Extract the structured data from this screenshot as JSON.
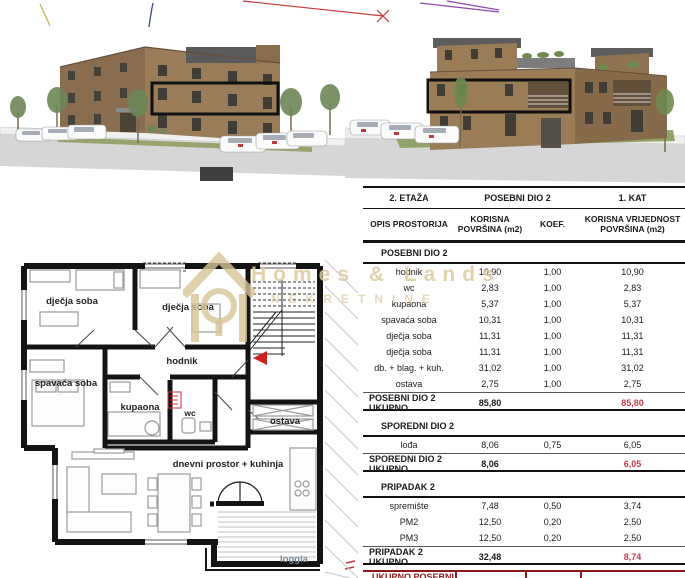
{
  "watermark": {
    "brand": "Homes & Lands",
    "subtitle": "NEKRETNINE"
  },
  "floor_plan": {
    "rooms": {
      "child1": "dječja soba",
      "child2": "dječja soba",
      "bedroom": "spavaća soba",
      "hall": "hodnik",
      "bathroom": "kupaona",
      "wc": "wc",
      "storage": "ostava",
      "living": "dnevni prostor + kuhinja",
      "loggia": "loggia"
    }
  },
  "table": {
    "floor_label": "2. ETAŽA",
    "unit_label": "POSEBNI DIO 2",
    "level_label": "1. KAT",
    "columns": [
      "OPIS PROSTORIJA",
      "KORISNA POVRŠINA (m2)",
      "KOEF.",
      "KORISNA VRIJEDNOST POVRŠINA (m2)"
    ],
    "sections": [
      {
        "title": "POSEBNI DIO 2",
        "rows": [
          [
            "hodnik",
            "10,90",
            "1,00",
            "10,90"
          ],
          [
            "wc",
            "2,83",
            "1,00",
            "2,83"
          ],
          [
            "kupaona",
            "5,37",
            "1,00",
            "5,37"
          ],
          [
            "spavaća soba",
            "10,31",
            "1,00",
            "10,31"
          ],
          [
            "dječja soba",
            "11,31",
            "1,00",
            "11,31"
          ],
          [
            "dječja soba",
            "11,31",
            "1,00",
            "11,31"
          ],
          [
            "db. + blag. + kuh.",
            "31,02",
            "1,00",
            "31,02"
          ],
          [
            "ostava",
            "2,75",
            "1,00",
            "2,75"
          ]
        ],
        "total": [
          "POSEBNI DIO 2 UKUPNO",
          "85,80",
          "",
          "85,80"
        ]
      },
      {
        "title": "SPOREDNI DIO 2",
        "rows": [
          [
            "lođa",
            "8,06",
            "0,75",
            "6,05"
          ]
        ],
        "total": [
          "SPOREDNI DIO 2 UKUPNO",
          "8,06",
          "",
          "6,05"
        ]
      },
      {
        "title": "PRIPADAK 2",
        "rows": [
          [
            "spremište",
            "7,48",
            "0,50",
            "3,74"
          ],
          [
            "PM2",
            "12,50",
            "0,20",
            "2,50"
          ],
          [
            "PM3",
            "12,50",
            "0,20",
            "2,50"
          ]
        ],
        "total": [
          "PRIPADAK 2 UKUPNO",
          "32,48",
          "",
          "8,74"
        ]
      }
    ],
    "grand_total": [
      "UKUPNO POSEBNI DIO 2",
      "126,34",
      "",
      "100,59"
    ]
  },
  "colors": {
    "accent_red": "#c63b4a",
    "maroon": "#8e1b1b",
    "wall_black": "#141414",
    "watermark_gold": "#dbca9c"
  }
}
